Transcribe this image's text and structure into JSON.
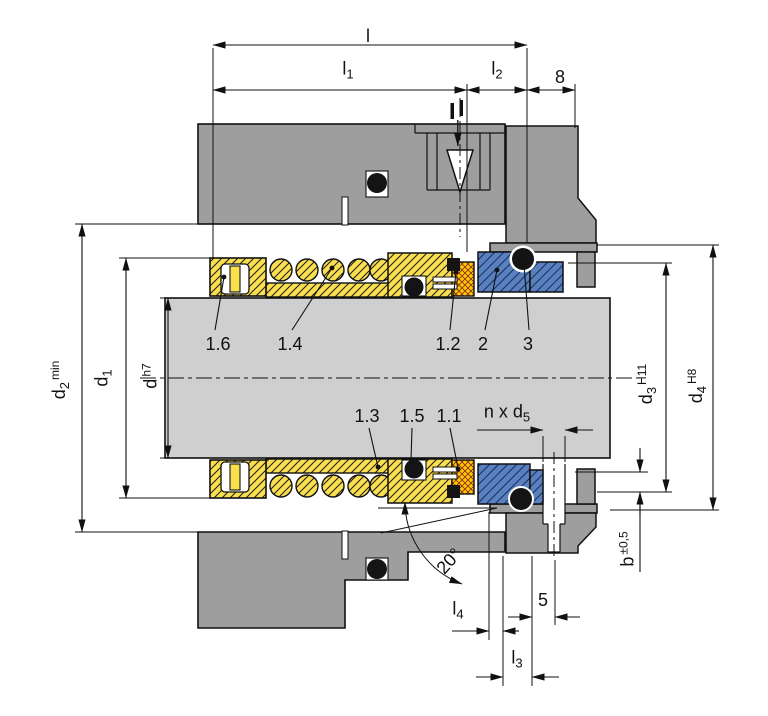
{
  "drawing_title": "mechanical-seal-cross-section",
  "colors": {
    "housing_gray": "#9e9e9e",
    "shaft_gray": "#cfcfcf",
    "rotating_unit_yellow": "#f9df4e",
    "seal_face_gold": "#ffc907",
    "stationary_seat_blue": "#5b80bf",
    "elastomer_black": "#141414",
    "line": "#111111"
  },
  "labels": {
    "l": {
      "base": "l"
    },
    "l1": {
      "base": "l",
      "sub": "1"
    },
    "l2": {
      "base": "l",
      "sub": "2"
    },
    "dim8": {
      "base": "8"
    },
    "d2": {
      "base": "d",
      "sub": "2",
      "sup": "min"
    },
    "d1": {
      "base": "d",
      "sub": "1"
    },
    "d_h7": {
      "base": "d",
      "sup": "h7"
    },
    "d3": {
      "base": "d",
      "sub": "3",
      "sup": "H11"
    },
    "d4": {
      "base": "d",
      "sub": "4",
      "sup": "H8"
    },
    "b": {
      "base": "b",
      "sup": "±0,5"
    },
    "n_x_d5": {
      "base": "n x d",
      "sub": "5"
    },
    "angle20": {
      "base": "20°"
    },
    "l4": {
      "base": "l",
      "sub": "4"
    },
    "dim5": {
      "base": "5"
    },
    "l3": {
      "base": "l",
      "sub": "3"
    }
  },
  "parts": {
    "p11": "1.1",
    "p12": "1.2",
    "p13": "1.3",
    "p14": "1.4",
    "p15": "1.5",
    "p16": "1.6",
    "p2": "2",
    "p3": "3"
  }
}
